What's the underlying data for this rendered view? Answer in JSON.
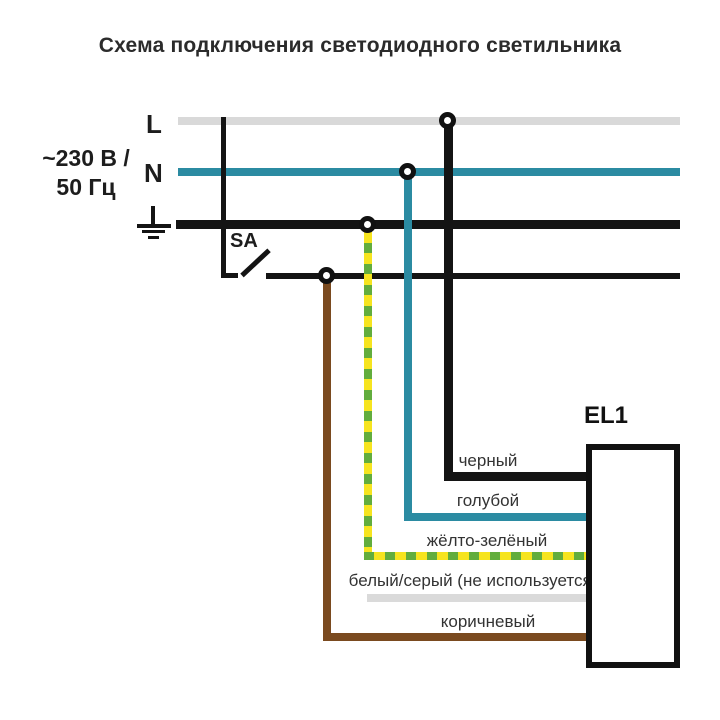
{
  "title": "Схема подключения светодиодного светильника",
  "power": {
    "rating_line1": "~230 В /",
    "rating_line2": "50 Гц",
    "phase_label": "L",
    "neutral_label": "N"
  },
  "switch_label": "SA",
  "luminaire_label": "EL1",
  "wire_labels": {
    "black": "черный",
    "blue": "голубой",
    "yellow_green": "жёлто-зелёный",
    "white_gray": "белый/серый (не используется)",
    "brown": "коричневый"
  },
  "colors": {
    "phase_bus": "#d9d9d9",
    "neutral": "#2b8ba2",
    "ground": "#141414",
    "yellow": "#f6e41f",
    "green": "#62ad3d",
    "white_gray_wire": "#dadada",
    "brown": "#7a4a1f",
    "text": "#333333",
    "heading": "#2b2b2b"
  }
}
